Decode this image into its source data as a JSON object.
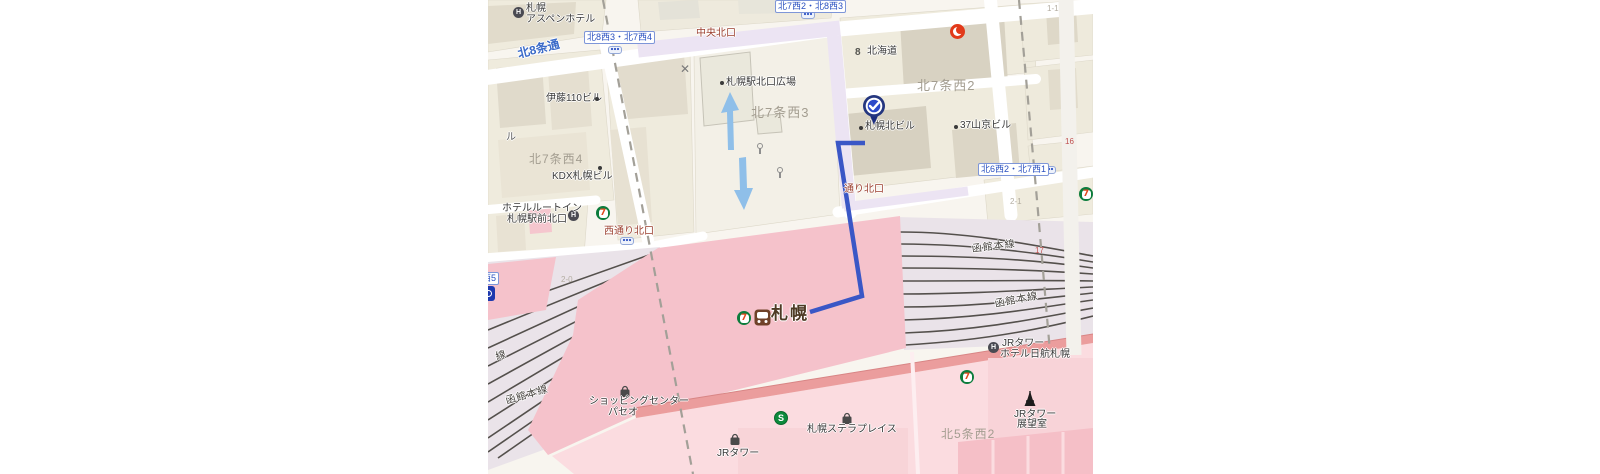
{
  "colors": {
    "route_blue": "#3a57c6",
    "station_pink": "#f5c2cb",
    "rail_yard_lavender": "#eae3e9",
    "light_pink": "#fbdce0",
    "salmon_road": "#eb9d9d",
    "purple_road": "#ece4f3",
    "intersection_blue": "#2a50c0",
    "exit_red": "#9c4030",
    "area_gray": "#a39d90",
    "seven_green": "#0c7c3c",
    "pin_navy": "#24367f",
    "arrow_lightblue": "#8fbfe9"
  },
  "icons": {
    "seven_glyph": "7",
    "subway_glyph": "S",
    "hotel_glyph": "H",
    "gov_glyph": "8",
    "x_mark": "✕"
  },
  "intersections": {
    "kita8w3_kita7w4": "北8西3・北7西4",
    "kita7w2_kita8w3": "北7西2・北8西3",
    "kita6w2_kita7w1": "北6西2・北7西1",
    "nishi5": "西5"
  },
  "roads": {
    "kita8_dori": "北8条通"
  },
  "exits": {
    "chuo_kitaguchi": "中央北口",
    "nishidori_kitaguchi": "西通り北口",
    "dori_kitaguchi": "通り北口"
  },
  "areas": {
    "kita7_nishi2": "北7条西2",
    "kita7_nishi3": "北7条西3",
    "kita7_nishi4": "北7条西4",
    "kita5_nishi2": "北5条西2"
  },
  "pois": {
    "aspen_line1": "札幌",
    "aspen_line2": "アスペンホテル",
    "hokkaido": "北海道",
    "sapporo_kita_bldg": "札幌北ビル",
    "sankyo_bldg": "37山京ビル",
    "ito110_bldg": "伊藤110ビル",
    "partial_ru": "ル",
    "kdx_bldg": "KDX札幌ビル",
    "routeinn_line1": "ホテルルートイン",
    "routeinn_line2": "札幌駅前北口",
    "kitaguchi_plaza": "札幌駅北口広場",
    "paseo_line1": "ショッピングセンター",
    "paseo_line2": "パセオ",
    "jr_tower": "JRタワー",
    "stellar_place": "札幌ステラプレイス",
    "nikko_line1": "JRタワー",
    "nikko_line2": "ホテル日航札幌",
    "obs_line1": "JRタワー",
    "obs_line2": "展望室"
  },
  "station": {
    "name": "札幌"
  },
  "rail": {
    "hakodate_r1": "函館本線",
    "hakodate_r2": "函館本線",
    "hakodate_l": "函館本線",
    "partial_sen": "線"
  },
  "plot_numbers": {
    "n16": "16",
    "n17": "17",
    "n2_1": "2-1",
    "n1_1": "1-1",
    "n2_0": "2-0"
  }
}
